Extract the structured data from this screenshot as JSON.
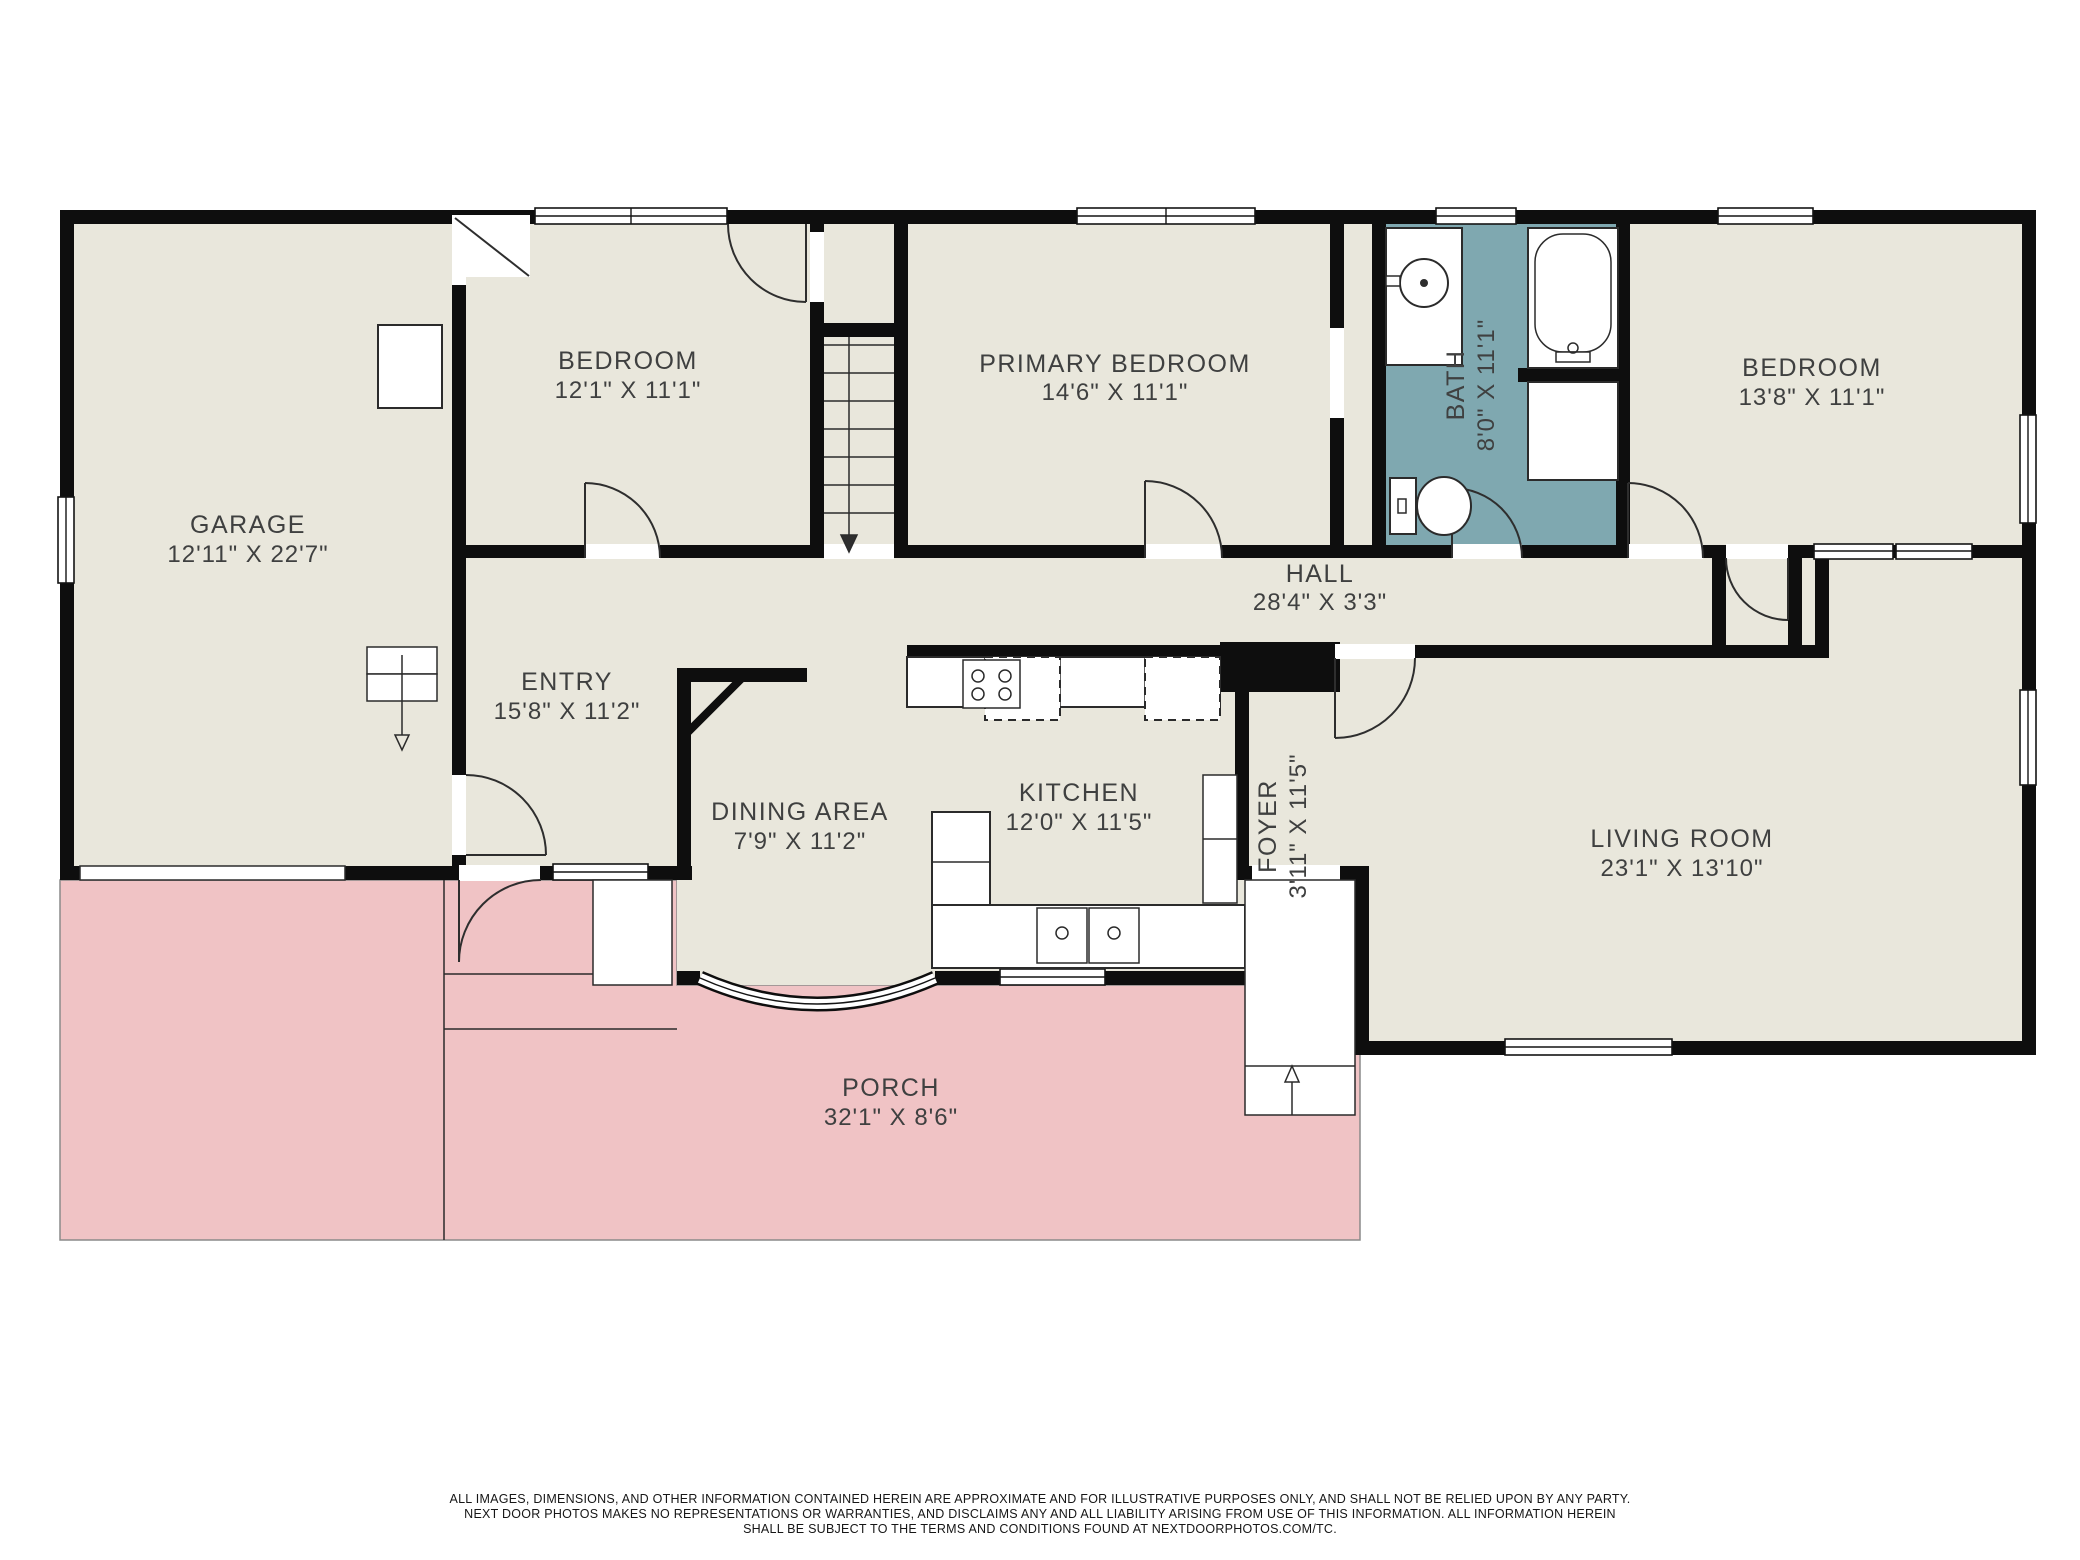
{
  "colors": {
    "floor": "#e9e7dc",
    "bath": "#7fa8b0",
    "porch": "#f0c3c5",
    "wall": "#0e0e0e",
    "line": "#2b2b2b",
    "text": "#3f4040"
  },
  "rooms": [
    {
      "name": "GARAGE",
      "dims": "12'11\" X 22'7\""
    },
    {
      "name": "BEDROOM",
      "dims": "12'1\" X 11'1\""
    },
    {
      "name": "PRIMARY BEDROOM",
      "dims": "14'6\" X 11'1\""
    },
    {
      "name": "BATH",
      "dims": "8'0\" X 11'1\""
    },
    {
      "name": "BEDROOM",
      "dims": "13'8\" X 11'1\""
    },
    {
      "name": "HALL",
      "dims": "28'4\" X 3'3\""
    },
    {
      "name": "ENTRY",
      "dims": "15'8\" X 11'2\""
    },
    {
      "name": "DINING AREA",
      "dims": "7'9\" X 11'2\""
    },
    {
      "name": "KITCHEN",
      "dims": "12'0\" X 11'5\""
    },
    {
      "name": "FOYER",
      "dims": "3'11\" X 11'5\""
    },
    {
      "name": "LIVING ROOM",
      "dims": "23'1\" X 13'10\""
    },
    {
      "name": "PORCH",
      "dims": "32'1\" X 8'6\""
    }
  ],
  "disclaimer": {
    "line1": "ALL IMAGES, DIMENSIONS, AND OTHER INFORMATION CONTAINED HEREIN ARE APPROXIMATE AND FOR ILLUSTRATIVE PURPOSES ONLY, AND SHALL NOT BE RELIED UPON BY ANY PARTY.",
    "line2": "NEXT DOOR PHOTOS MAKES NO REPRESENTATIONS OR WARRANTIES, AND DISCLAIMS ANY AND ALL LIABILITY ARISING FROM USE OF THIS INFORMATION. ALL INFORMATION HEREIN",
    "line3": "SHALL BE SUBJECT TO THE TERMS AND CONDITIONS FOUND AT NEXTDOORPHOTOS.COM/TC."
  }
}
